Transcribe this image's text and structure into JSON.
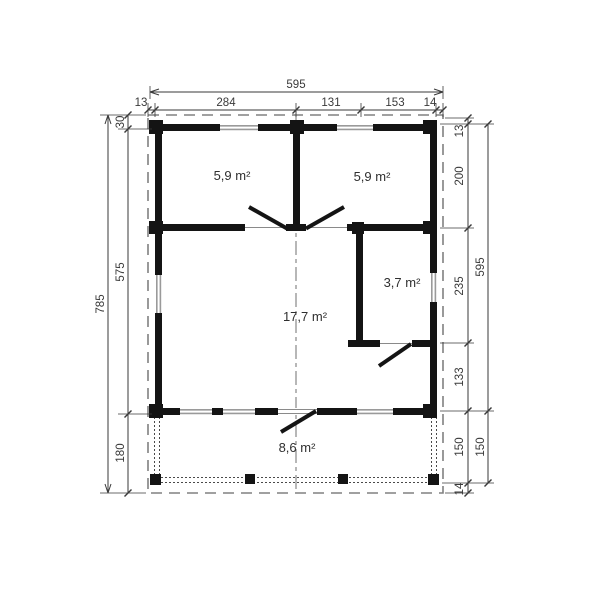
{
  "drawing": {
    "rooms": {
      "top_left": "5,9 m²",
      "top_right": "5,9 m²",
      "side": "3,7 m²",
      "main": "17,7 m²",
      "terrace": "8,6 m²"
    },
    "dimensions": {
      "top_total": "595",
      "top_chain": [
        "13",
        "284",
        "131",
        "153",
        "14"
      ],
      "left_total": "785",
      "left_chain": [
        "30",
        "575",
        "180"
      ],
      "right_outer": [
        "595",
        "150"
      ],
      "right_chain": [
        "13",
        "200",
        "235",
        "133",
        "150",
        "14"
      ]
    },
    "colors": {
      "wall": "#141414",
      "window": "#9a9a9a",
      "dimension": "#3a3a3a",
      "outline": "#808080",
      "background": "#ffffff"
    }
  }
}
